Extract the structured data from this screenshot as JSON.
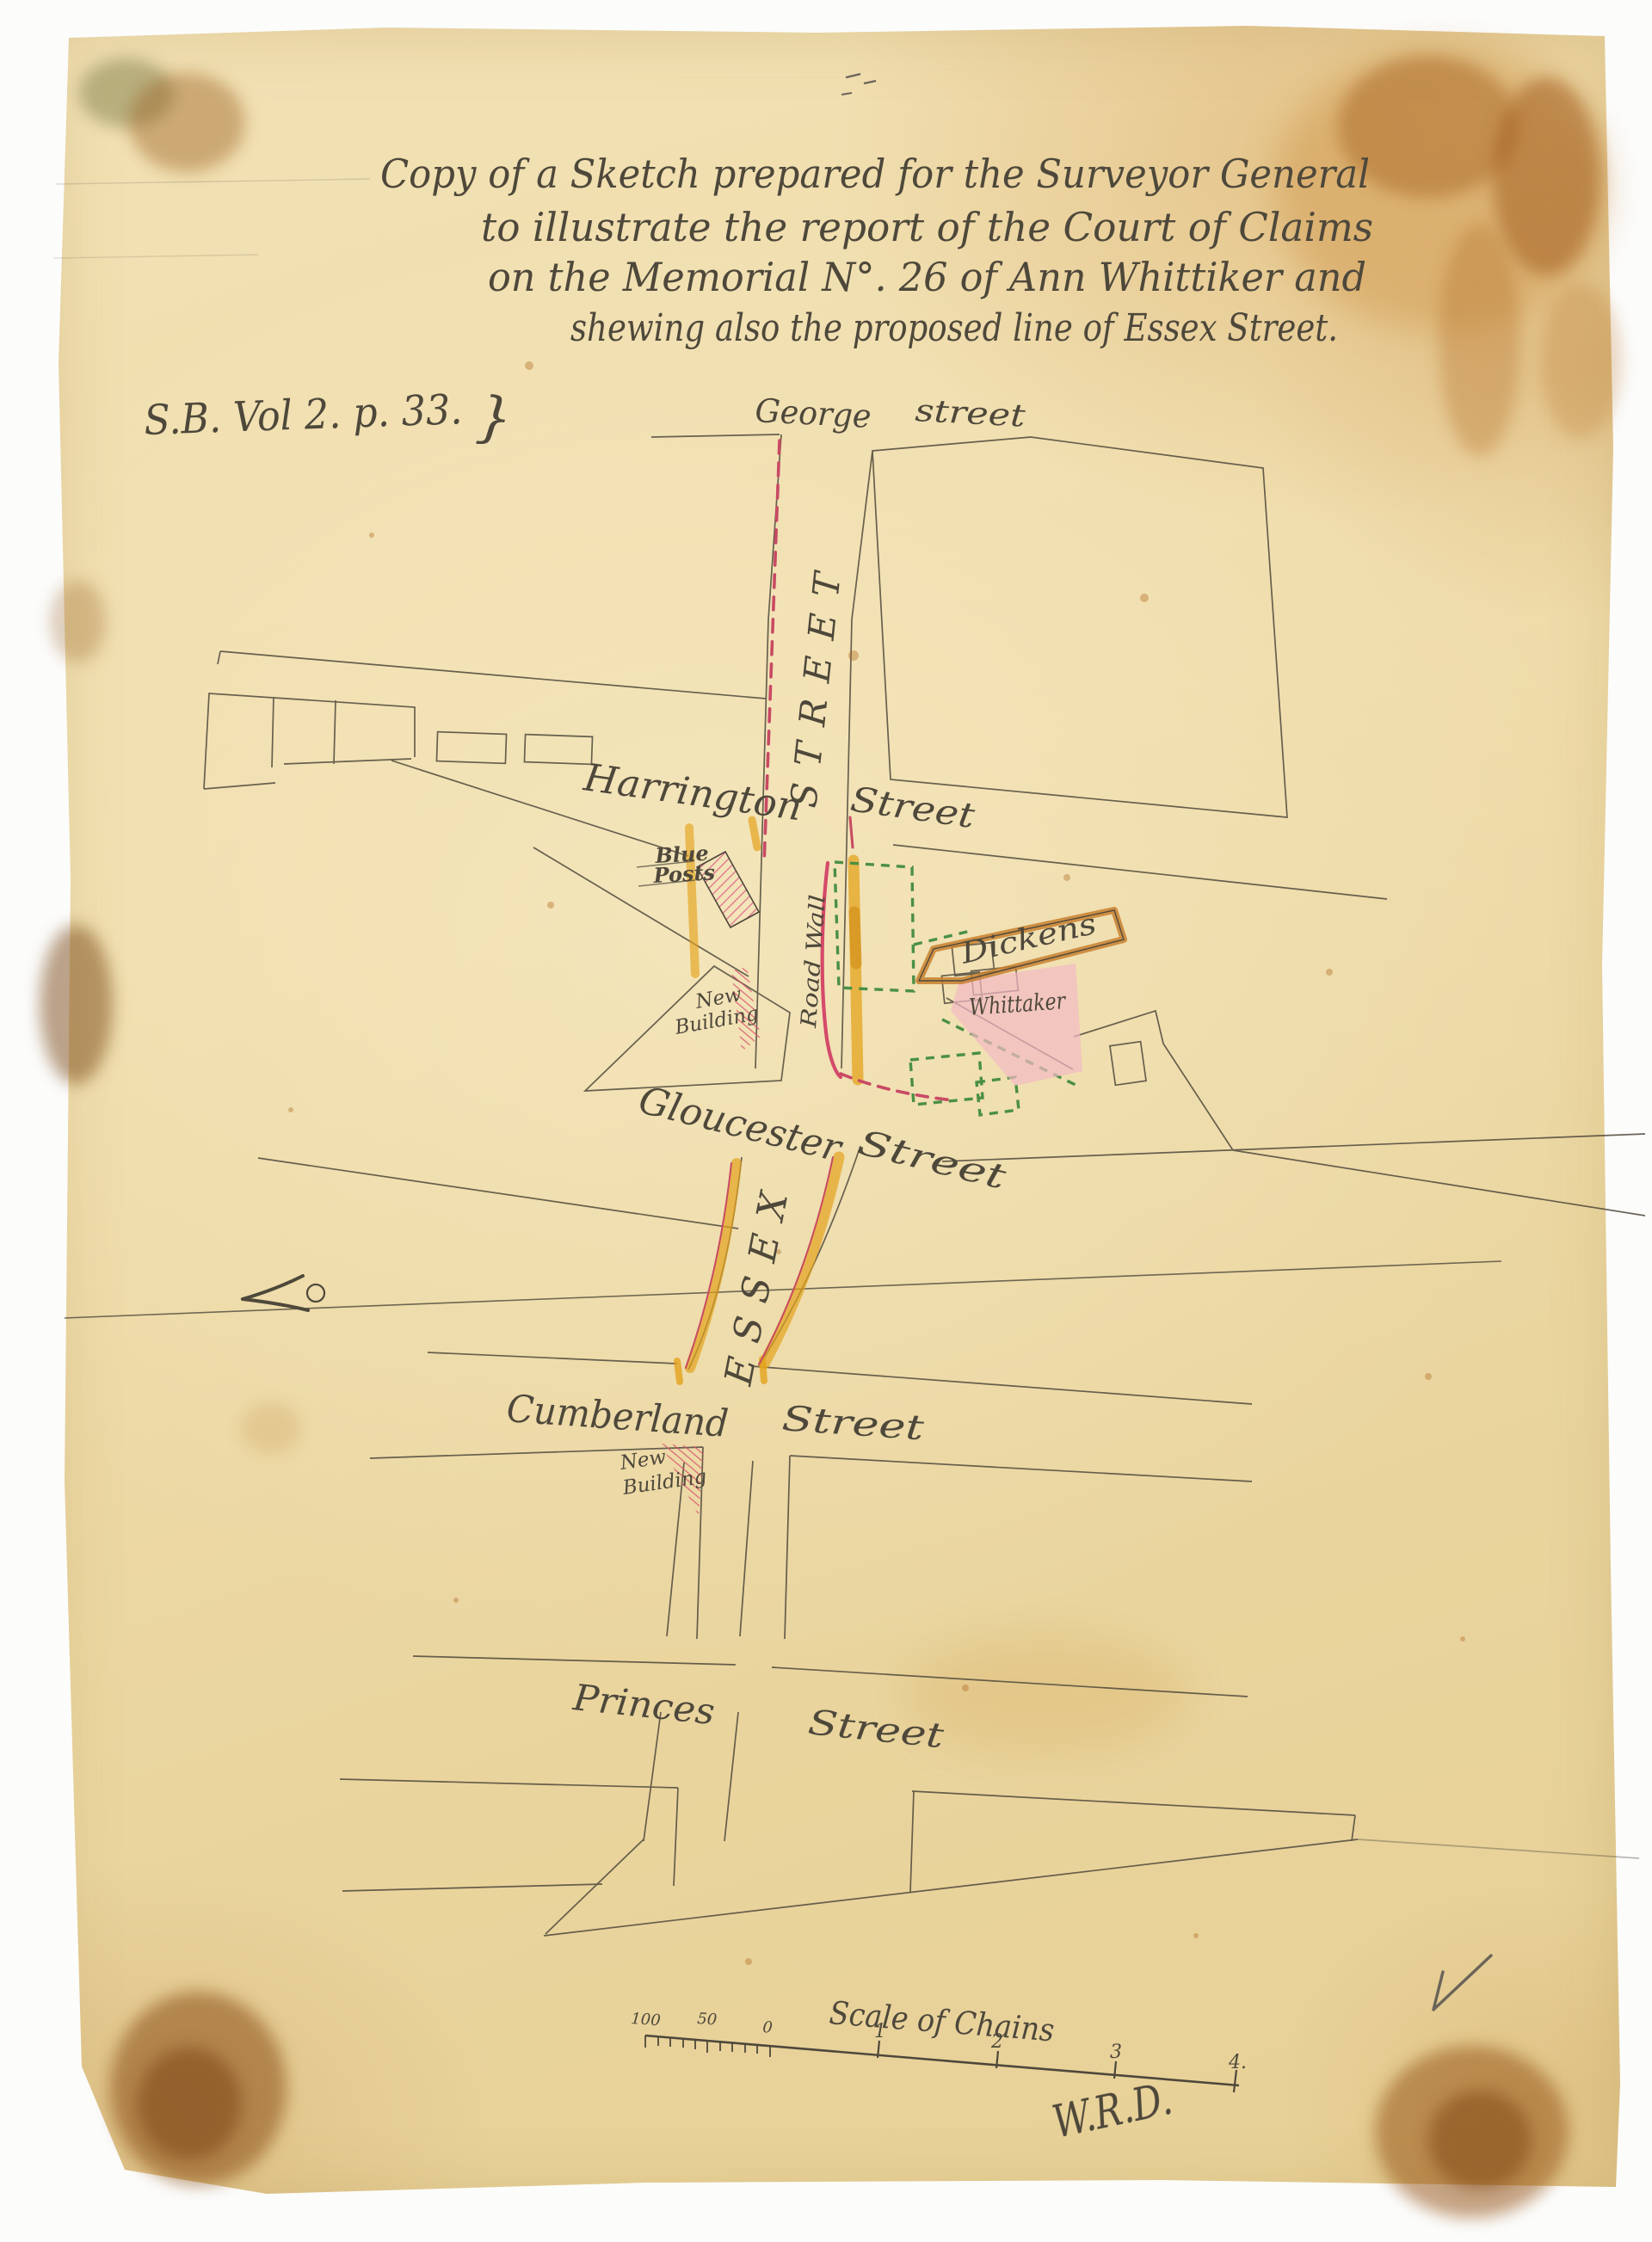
{
  "title": {
    "line1": "Copy of a Sketch prepared for the Surveyor General",
    "line2": "to illustrate the report of the Court of Claims",
    "line3": "on the Memorial N°. 26 of Ann Whittiker and",
    "line4": "shewing also the proposed line of Essex Street."
  },
  "reference": {
    "text": "S.B. Vol 2. p. 33.",
    "brace": "}"
  },
  "streets": {
    "george": {
      "first": "George",
      "second": "street"
    },
    "central_vertical": "STREET",
    "harrington": {
      "first": "Harrington",
      "second": "Street"
    },
    "gloucester": {
      "first": "Gloucester",
      "second": "Street"
    },
    "essex_vertical": "ESSEX",
    "cumberland": {
      "first": "Cumberland",
      "second": "Street"
    },
    "princes": {
      "first": "Princes",
      "second": "Street"
    }
  },
  "features": {
    "blue_posts": {
      "line1": "Blue",
      "line2": "Posts"
    },
    "road_wall": "Road Wall",
    "dickens": "Dickens",
    "whittaker": "Whittaker",
    "new_building_upper": {
      "line1": "New",
      "line2": "Building"
    },
    "new_building_lower": {
      "line1": "New",
      "line2": "Building"
    }
  },
  "scale_bar": {
    "title": "Scale of Chains",
    "ticks": [
      "100",
      "50",
      "0",
      "1",
      "2",
      "3",
      "4."
    ],
    "signature": "W.R.D."
  },
  "icons": {
    "checkmark": "check-mark-icon",
    "survey_arrow": "survey-arrow-icon"
  },
  "colors": {
    "ink": "#4e483b",
    "pencil": "#6a6459",
    "proposed_line_red": "#c84a64",
    "wash_yellow": "#e3a31c",
    "dashed_green": "#4a8f45",
    "building_pink": "#f2b9c4",
    "hatch_pink": "#e1718d",
    "dickens_orange": "#c8802f",
    "paper": "#efddab"
  }
}
